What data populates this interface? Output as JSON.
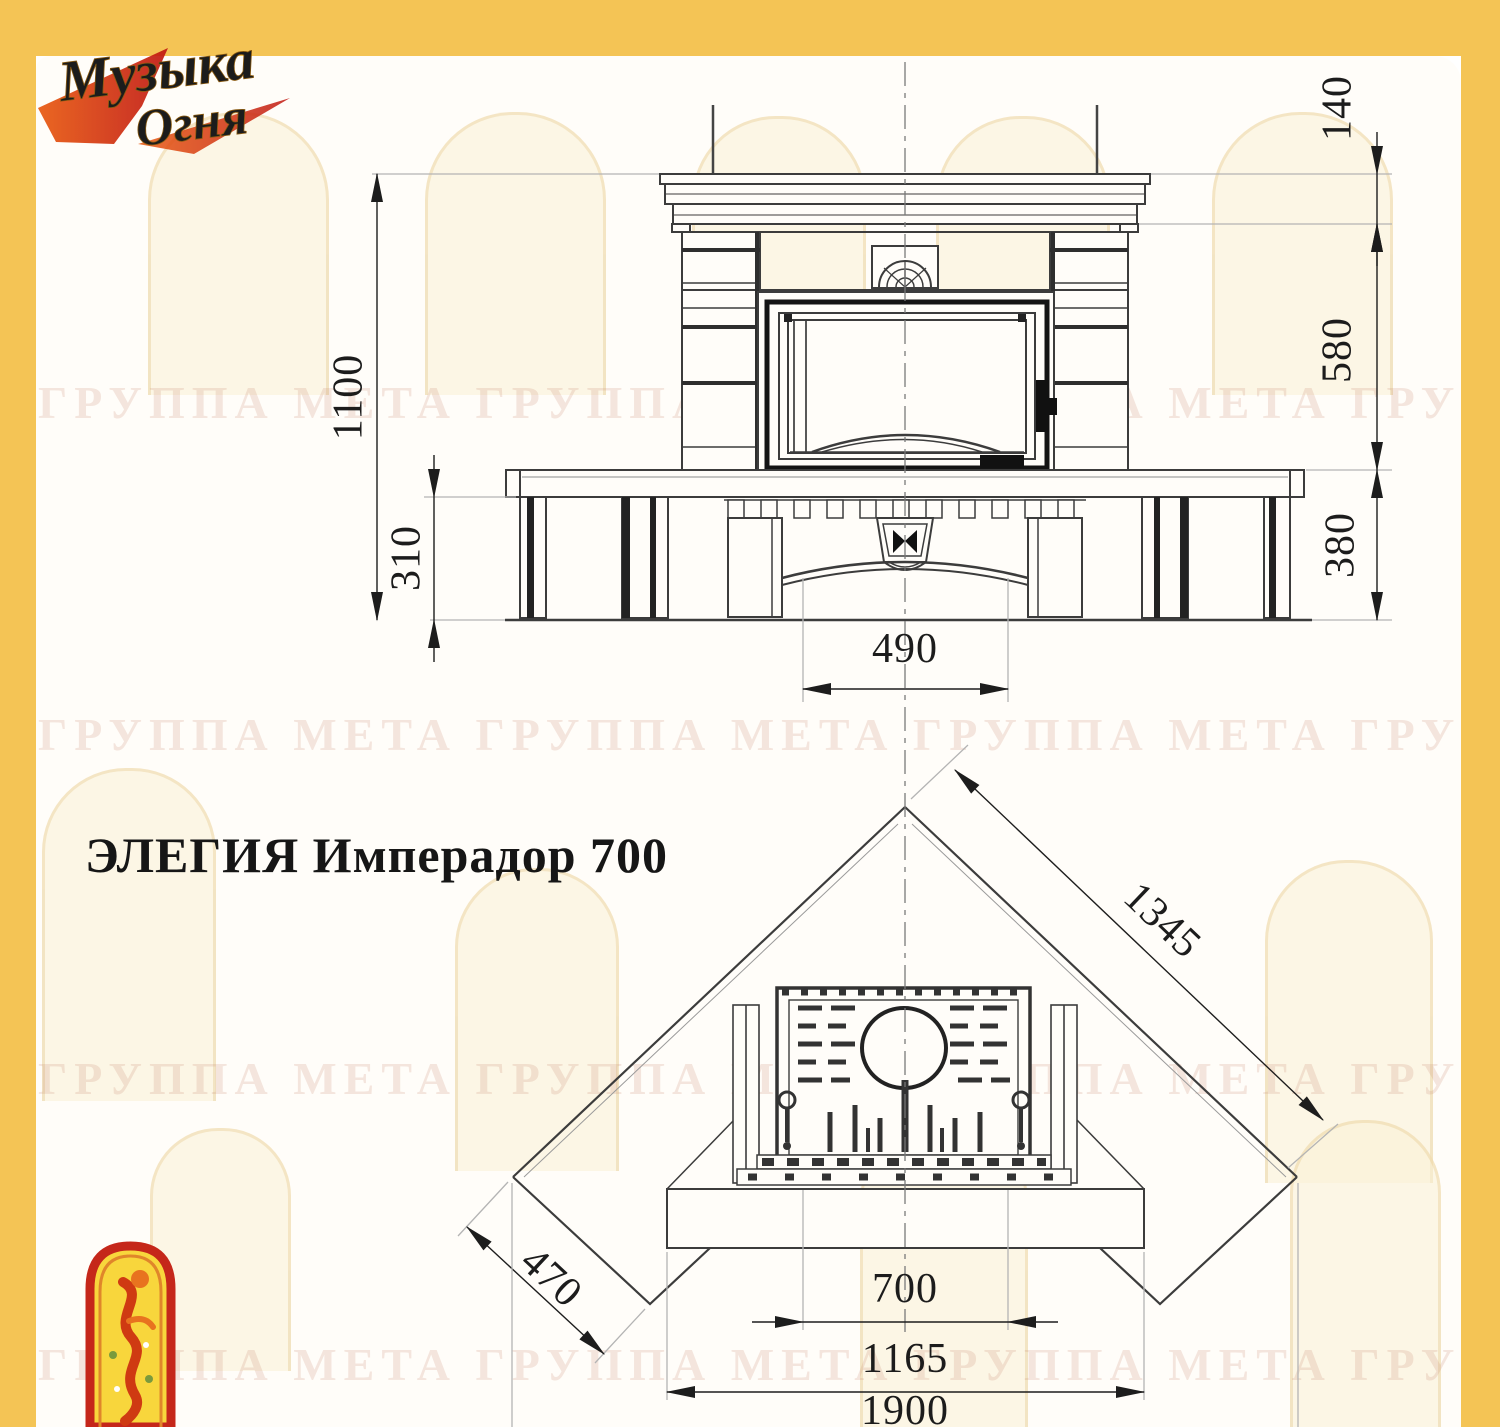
{
  "logo": {
    "line1": "Музыка",
    "line2": "Огня"
  },
  "watermark": {
    "text": "ГРУППА МЕТА ГРУППА МЕТА ГРУППА МЕТА ГРУППА МЕТА ГРУППА МЕТА ГРУППА МЕТА"
  },
  "title": {
    "text": "ЭЛЕГИЯ Имперадор 700"
  },
  "front_view": {
    "dimensions": {
      "total_height": "1100",
      "bench_leg_height": "310",
      "cornice_height": "140",
      "body_height": "580",
      "bench_height": "380",
      "base_width": "490"
    }
  },
  "plan_view": {
    "dimensions": {
      "wall_side": "1345",
      "bench_wing": "470",
      "firebox_width": "700",
      "hearth_width": "1165",
      "overall_width": "1900"
    }
  },
  "colors": {
    "frame_yellow": "#f4c455",
    "logo_gold": "#d9951f",
    "logo_red": "#cf2a16",
    "line_dark": "#3c3c3c",
    "line_grey": "#adadad",
    "watermark_pink": "rgba(198,134,112,0.20)"
  }
}
